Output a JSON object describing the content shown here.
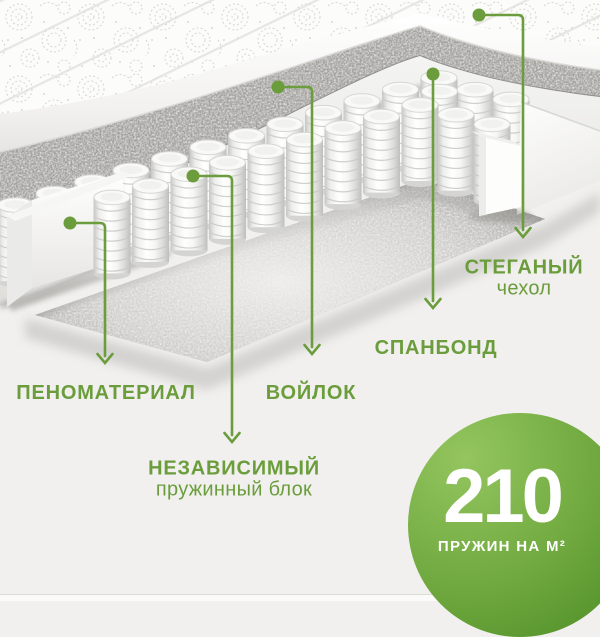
{
  "illustration": {
    "subject": "mattress cutaway 3d render"
  },
  "labels": {
    "foam": {
      "title": "ПЕНОМАТЕРИАЛ"
    },
    "springs": {
      "title": "НЕЗАВИСИМЫЙ",
      "subtitle": "пружинный блок"
    },
    "felt": {
      "title": "ВОЙЛОК"
    },
    "spunbond": {
      "title": "СПАНБОНД"
    },
    "cover": {
      "title": "СТЕГАНЫЙ",
      "subtitle": "чехол"
    }
  },
  "badge": {
    "value": "210",
    "caption": "ПРУЖИН НА М²"
  },
  "colors": {
    "accent": "#6b9d3c",
    "badge_gradient_start": "#94c55f",
    "badge_gradient_end": "#53902a"
  }
}
